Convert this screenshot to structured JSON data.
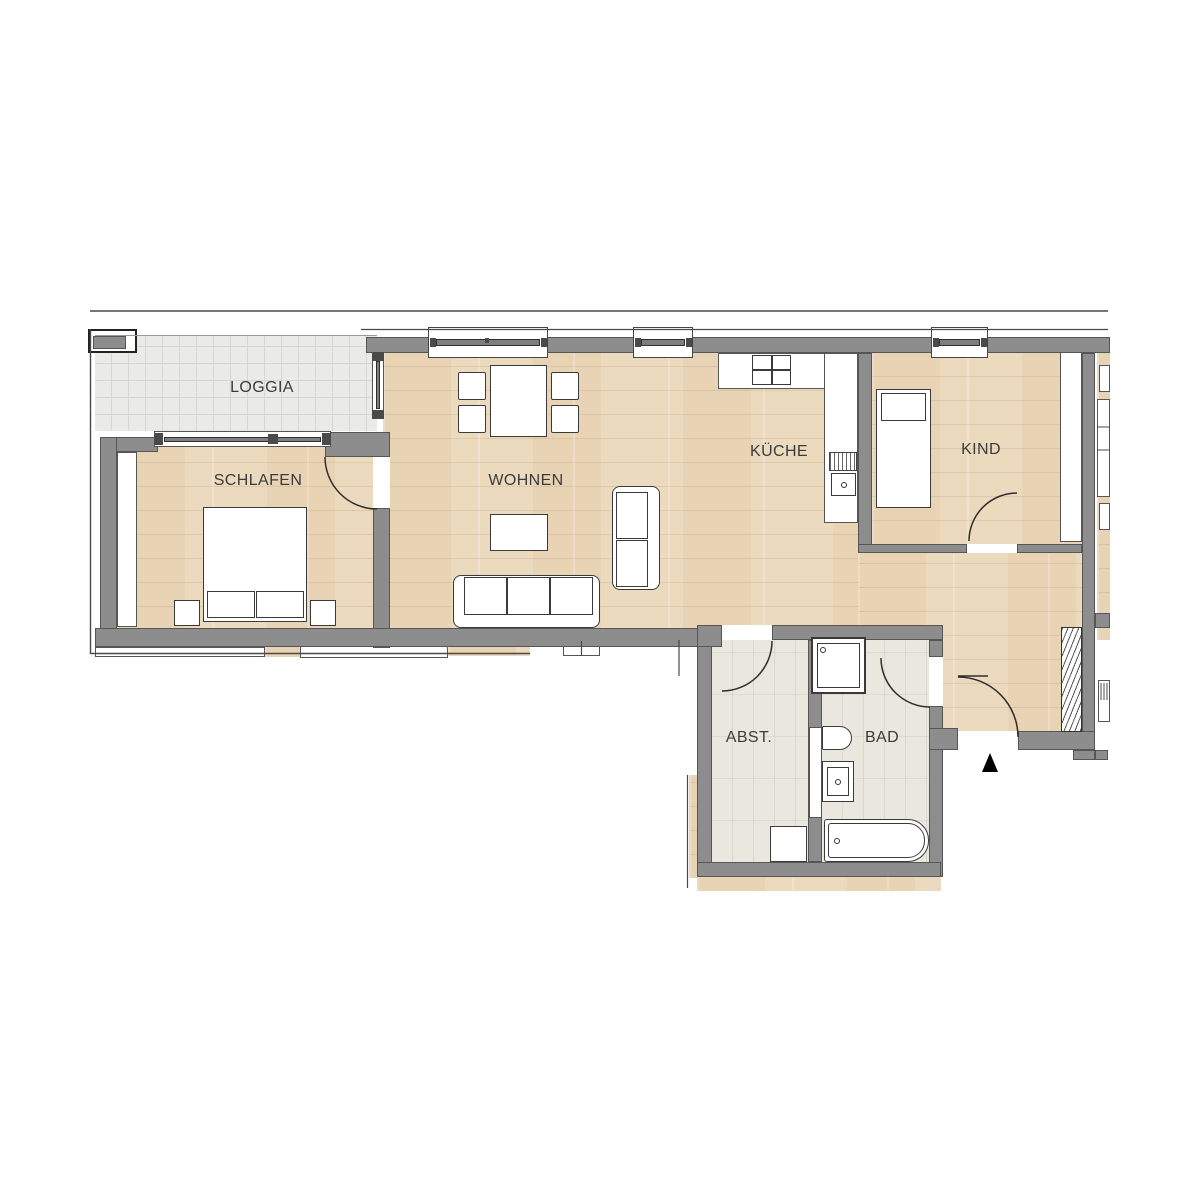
{
  "plan": {
    "type": "apartment-floor-plan",
    "language": "de",
    "rooms": {
      "loggia": {
        "label": "LOGGIA"
      },
      "schlafen": {
        "label": "SCHLAFEN"
      },
      "wohnen": {
        "label": "WOHNEN"
      },
      "kueche": {
        "label": "KÜCHE"
      },
      "kind": {
        "label": "KIND"
      },
      "abstellraum": {
        "label": "ABST."
      },
      "bad": {
        "label": "BAD"
      }
    },
    "entrance": {
      "marker": "triangle-up",
      "location": "south-east"
    },
    "colors": {
      "wall": "#8d8d8d",
      "wall_outline": "#565656",
      "wood_floor": "#ecdabe",
      "loggia_floor": "#eaeae7",
      "bath_floor": "#eae7de",
      "furniture_fill": "#ffffff",
      "furniture_line": "#3a3a3a",
      "marker": "#000000"
    },
    "fixtures": [
      "double-bed",
      "nightstand",
      "wardrobe",
      "dining-table",
      "chair",
      "coffee-table",
      "three-seat-sofa",
      "two-seat-sofa",
      "kitchen-counter",
      "stove",
      "kitchen-sink",
      "single-bed",
      "child-wardrobe",
      "shower",
      "toilet",
      "washbasin",
      "bathtub",
      "washing-machine",
      "radiator",
      "window",
      "door-swing"
    ]
  }
}
